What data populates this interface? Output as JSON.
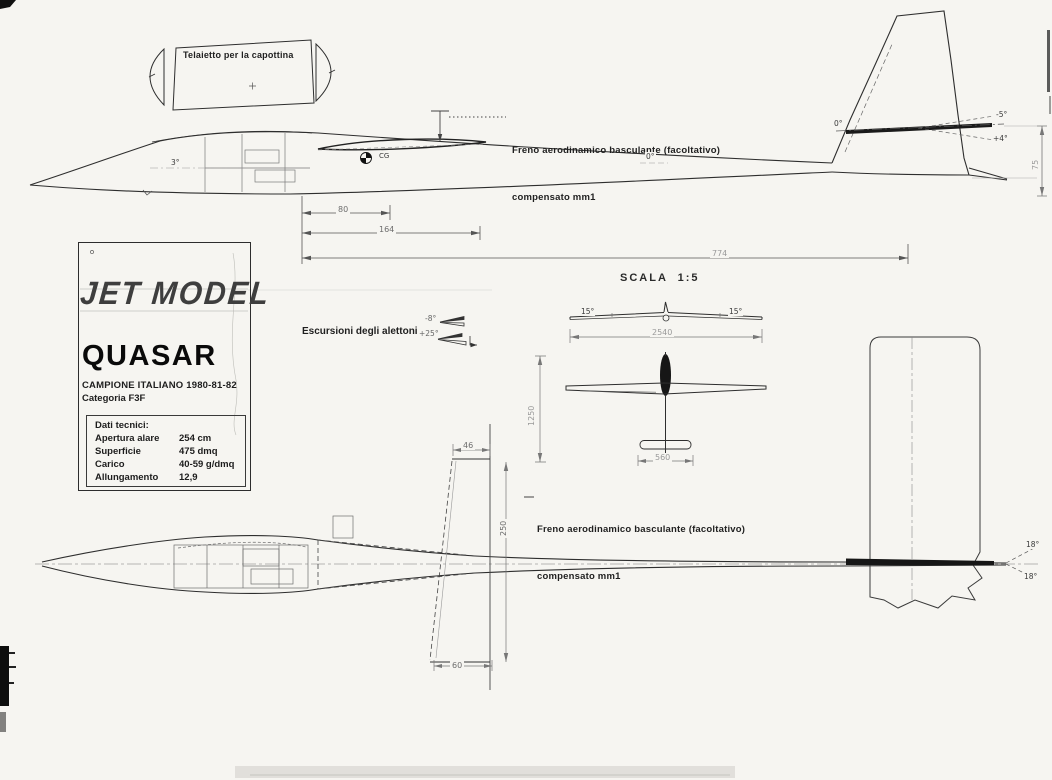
{
  "colors": {
    "paper": "#f6f5f1",
    "ink": "#2e2e2e",
    "faint_dim": "#9a9a9a"
  },
  "labels": {
    "canopy": "Telaietto per la capottina",
    "airbrake_line1": "Freno aerodinamico basculante (facoltativo)",
    "airbrake_line2": "compensato mm1",
    "scale": "SCALA  1:5",
    "aileron_throws": "Escursioni degli alettoni",
    "aileron_up": "-8°",
    "aileron_down": "+25°"
  },
  "title_block": {
    "brand": "JET MODEL",
    "model": "QUASAR",
    "champion": "CAMPIONE ITALIANO 1980-81-82",
    "category": "Categoria  F3F",
    "specs_title": "Dati tecnici:",
    "specs": [
      {
        "label": "Apertura alare",
        "value": "254  cm"
      },
      {
        "label": "Superficie",
        "value": "475  dmq"
      },
      {
        "label": "Carico",
        "value": "40-59  g/dmq"
      },
      {
        "label": "Allungamento",
        "value": "12,9"
      }
    ]
  },
  "side_view": {
    "nose_setting": "3°",
    "wing_setting": "0°",
    "stab_setting": "0°",
    "elevator_up": "-5°",
    "elevator_down": "+4°",
    "cg": "CG",
    "fin_dim": "75",
    "dim_1": "80",
    "dim_2": "164",
    "dim_3": "774"
  },
  "front_view": {
    "dihedral_left": "15°",
    "dihedral_right": "15°",
    "span": "2540"
  },
  "overview_top_view": {
    "length": "1250",
    "stab_span": "560"
  },
  "plan_view": {
    "fin_root_chord": "46",
    "fin_height": "250",
    "fin_tip_chord": "60",
    "rudder_up": "18°",
    "rudder_down": "18°"
  }
}
